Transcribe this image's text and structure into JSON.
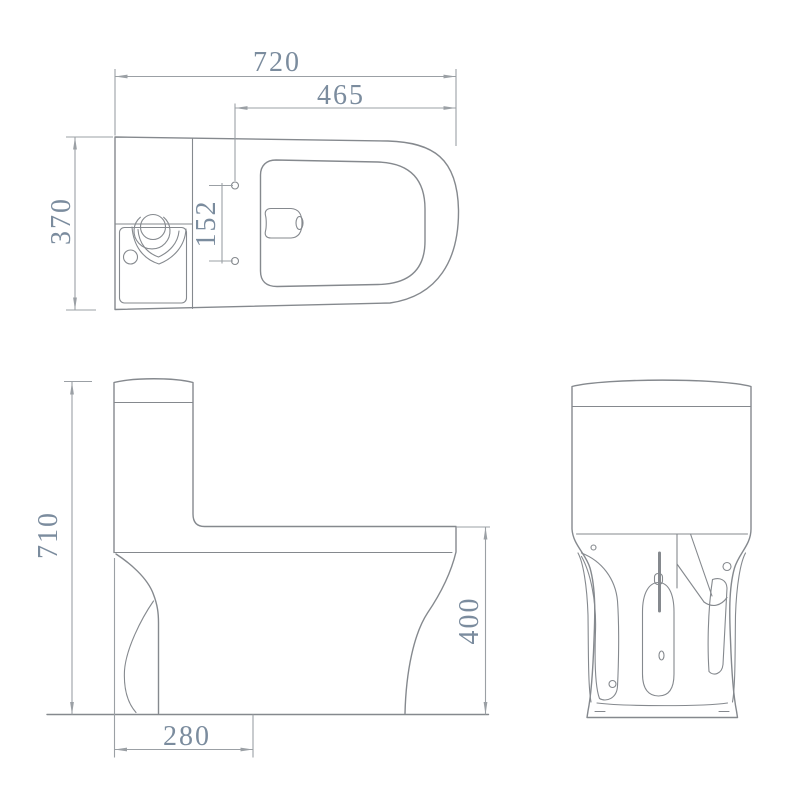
{
  "document": {
    "type": "toilet-technical-drawing",
    "views": {
      "top_view_name": "plan view",
      "side_view_name": "side elevation",
      "rear_view_name": "rear view"
    }
  },
  "dimensions": {
    "top_view": {
      "overall_length": "720",
      "bowl_length": "465",
      "overall_width": "370",
      "bolt_hole_spacing": "152"
    },
    "side_view": {
      "overall_height": "710",
      "bowl_height": "400",
      "rough_in": "280"
    }
  },
  "colors": {
    "background_color": "#ffffff",
    "line_color": "#85898e",
    "dimension_color": "#9ba0a5",
    "text_color": "#7b8c9e"
  }
}
